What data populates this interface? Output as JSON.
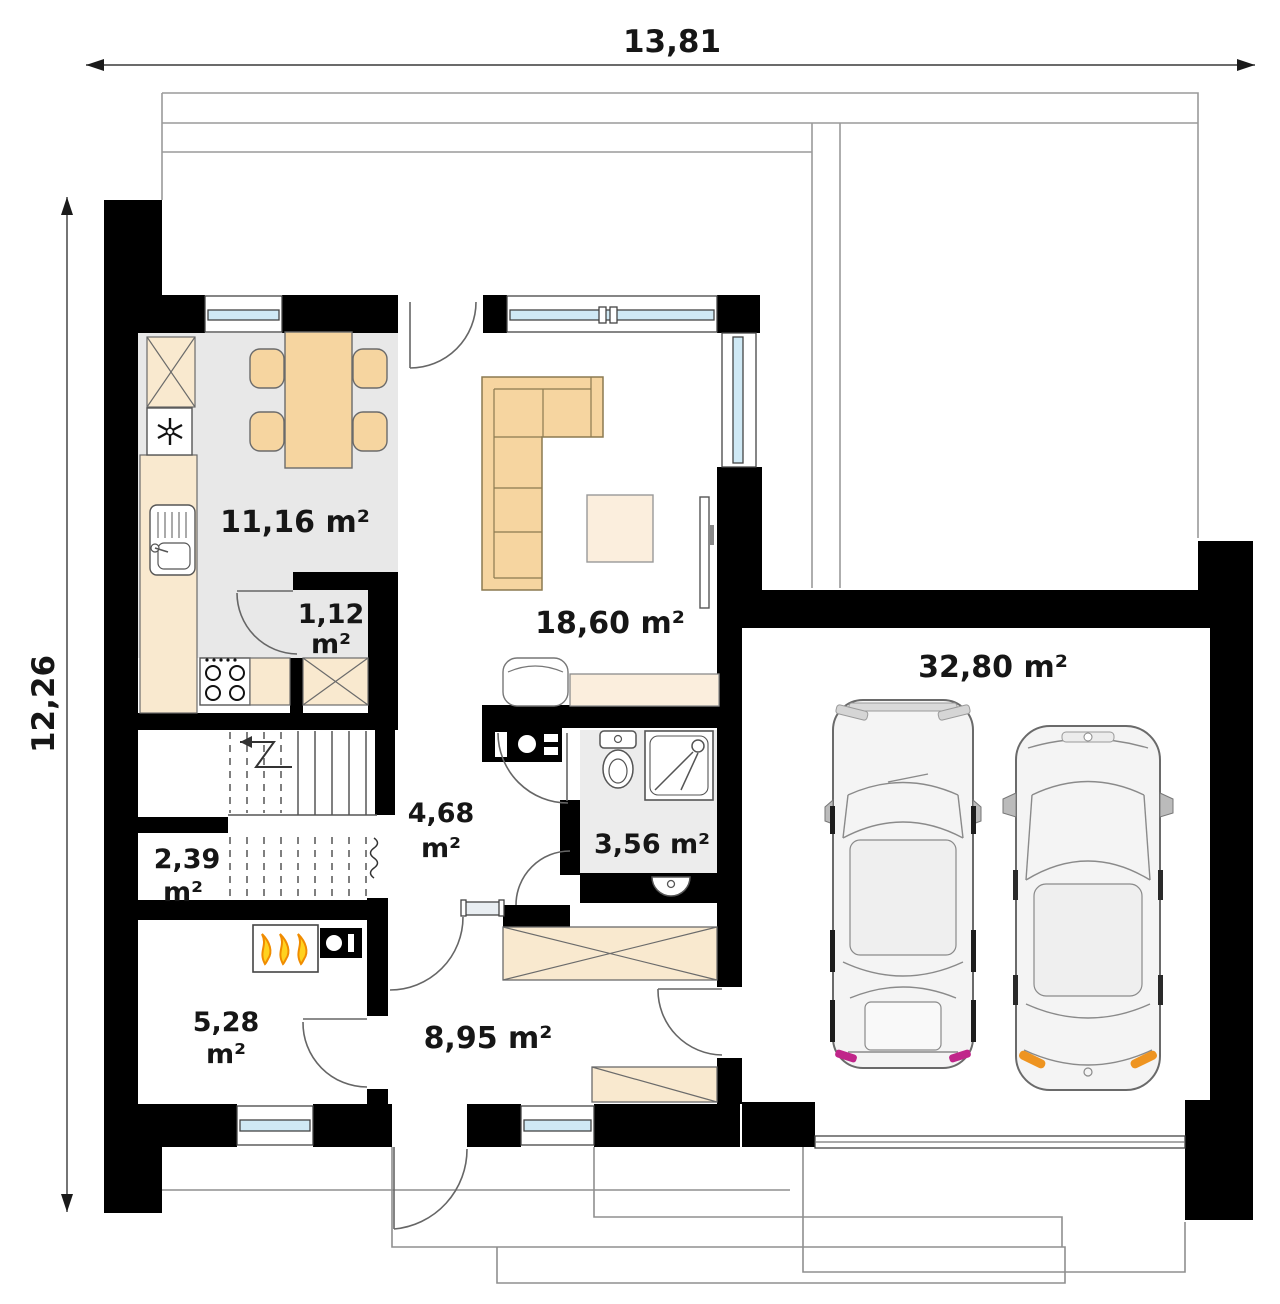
{
  "plan_title": "ground-floor-plan",
  "dimensions": {
    "width_label": "13,81",
    "height_label": "12,26"
  },
  "rooms": {
    "kitchen": {
      "area": "11,16 m²"
    },
    "pantry": {
      "area_line1": "1,12",
      "area_line2": "m²"
    },
    "living": {
      "area": "18,60 m²"
    },
    "garage": {
      "area": "32,80 m²"
    },
    "bathroom": {
      "area": "3,56 m²"
    },
    "hall": {
      "area_line1": "4,68",
      "area_line2": "m²"
    },
    "understairs": {
      "area_line1": "2,39",
      "area_line2": "m²"
    },
    "utility": {
      "area_line1": "5,28",
      "area_line2": "m²"
    },
    "entry": {
      "area": "8,95 m²"
    }
  },
  "icons": {
    "fridge": "snowflake",
    "boiler": "triple-flame",
    "stove": "four-burner-circles",
    "wardrobe": "x-cross-box",
    "stairs": "treads-with-up-arrow",
    "shower": "square-with-diagonals",
    "dimension": "double-headed-arrow"
  },
  "colors": {
    "wall": "#000000",
    "furniture_tan": "#f6d5a0",
    "furniture_cream": "#f9e9cf",
    "furniture_light": "#fbeedd",
    "floor_gray": "#e8e8e8",
    "glazing_blue": "#cfe9f5",
    "flame_yellow": "#ffd21f",
    "flame_orange": "#f08c00",
    "car_accent_orange": "#ee9421",
    "car_accent_magenta": "#c0268a"
  }
}
